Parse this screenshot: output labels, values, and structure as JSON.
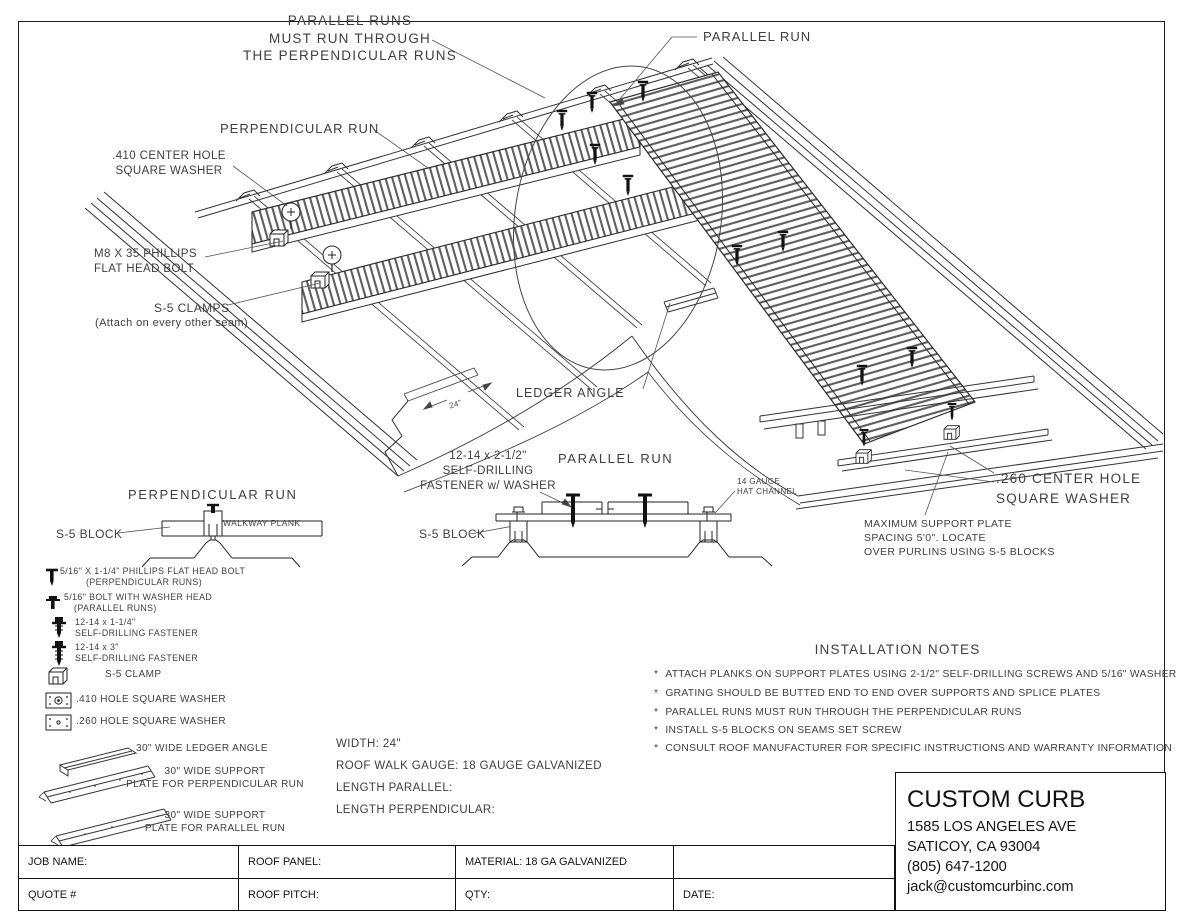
{
  "callouts": {
    "parallel_runs_note": "PARALLEL RUNS\nMUST RUN THROUGH\nTHE  PERPENDICULAR RUNS",
    "parallel_run_top": "PARALLEL RUN",
    "perpendicular_run": "PERPENDICULAR RUN",
    "center_hole_410": ".410 CENTER HOLE\nSQUARE WASHER",
    "m8_bolt": "M8 X 35 PHILLIPS\nFLAT HEAD BOLT",
    "s5_clamps": "S-5 CLAMPS",
    "s5_clamps_sub": "(Attach on every other seam)",
    "ledger_angle": "LEDGER ANGLE",
    "dim_24": "24\"",
    "fastener_212": "12-14 x 2-1/2\"\nSELF-DRILLING\nFASTENER w/ WASHER",
    "parallel_run_detail_title": "PARALLEL RUN",
    "hat_channel": "14 GAUGE\nHAT CHANNEL",
    "s5_block_parallel": "S-5 BLOCK",
    "center_hole_260": ".260 CENTER HOLE\nSQUARE WASHER",
    "max_support": "MAXIMUM SUPPORT PLATE\nSPACING 5'0\".  LOCATE\nOVER PURLINS USING S-5 BLOCKS",
    "perpendicular_detail_title": "PERPENDICULAR RUN",
    "s5_block_perpendicular": "S-5 BLOCK",
    "walkway_plank": "WALKWAY PLANK"
  },
  "legend": {
    "items": [
      {
        "label": "5/16\" X 1-1/4\" PHILLIPS FLAT HEAD BOLT",
        "sub": "(PERPENDICULAR RUNS)",
        "icon": "flat-head-bolt"
      },
      {
        "label": "5/16\" BOLT WITH WASHER HEAD",
        "sub": "(PARALLEL RUNS)",
        "icon": "washer-head-bolt"
      },
      {
        "label": "12-14 x 1-1/4\"",
        "sub": "SELF-DRILLING FASTENER",
        "icon": "self-drilling-fastener"
      },
      {
        "label": "12-14 x 3\"",
        "sub": "SELF-DRILLING FASTENER",
        "icon": "self-drilling-fastener-long"
      },
      {
        "label": "S-5 CLAMP",
        "icon": "s5-clamp"
      },
      {
        "label": ".410 HOLE SQUARE WASHER",
        "icon": "square-washer-410"
      },
      {
        "label": ".260 HOLE SQUARE WASHER",
        "icon": "square-washer-260"
      },
      {
        "label": "30\" WIDE LEDGER ANGLE",
        "icon": "ledger-angle"
      },
      {
        "label": "30\" WIDE SUPPORT\nPLATE FOR PERPENDICULAR RUN",
        "icon": "support-plate"
      },
      {
        "label": "30\" WIDE SUPPORT\nPLATE FOR PARALLEL RUN",
        "icon": "support-plate"
      }
    ]
  },
  "specs": {
    "width": "WIDTH: 24\"",
    "gauge": "ROOF WALK GAUGE: 18 GAUGE GALVANIZED",
    "length_parallel": "LENGTH PARALLEL:",
    "length_perpendicular": "LENGTH PERPENDICULAR:"
  },
  "installation_notes": {
    "title": "INSTALLATION NOTES",
    "bullet": "*",
    "items": [
      "ATTACH PLANKS ON SUPPORT PLATES USING 2-1/2\" SELF-DRILLING SCREWS AND 5/16\" WASHER",
      "GRATING SHOULD BE BUTTED END TO END OVER SUPPORTS AND SPLICE PLATES",
      "PARALLEL RUNS MUST RUN THROUGH THE PERPENDICULAR RUNS",
      "INSTALL S-5 BLOCKS ON SEAMS SET SCREW",
      "CONSULT ROOF MANUFACTURER FOR SPECIFIC INSTRUCTIONS AND WARRANTY INFORMATION"
    ]
  },
  "company": {
    "name": "CUSTOM CURB",
    "address1": "1585 LOS ANGELES AVE",
    "address2": "SATICOY, CA  93004",
    "phone": "(805) 647-1200",
    "email": "jack@customcurbinc.com"
  },
  "job_table": {
    "row1": [
      "JOB NAME:",
      "ROOF PANEL:",
      "MATERIAL:  18 GA GALVANIZED",
      ""
    ],
    "row2": [
      "QUOTE #",
      "ROOF PITCH:",
      "QTY:",
      "DATE:"
    ]
  }
}
